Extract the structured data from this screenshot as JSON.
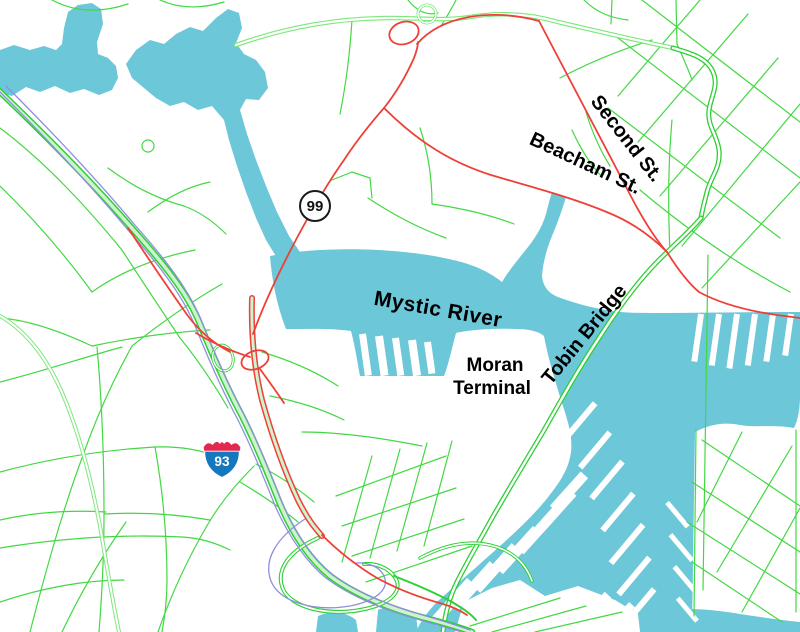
{
  "map": {
    "labels": {
      "second_st": "Second St.",
      "beacham_st": "Beacham St.",
      "mystic_river": "Mystic River",
      "moran_terminal_line1": "Moran",
      "moran_terminal_line2": "Terminal",
      "tobin_bridge": "Tobin Bridge"
    },
    "shields": {
      "interstate_93": "93",
      "route_99": "99"
    },
    "colors": {
      "water": "#6cc7d9",
      "land": "#ffffff",
      "road_minor": "#43d843",
      "highway_casing": "#2ecf35",
      "highway_fill": "#cdf4cd",
      "parkway_casing": "#7de87d",
      "road_red": "#ee4038",
      "rail": "#8f8fde",
      "shield_blue": "#1578bd",
      "shield_red": "#e22a50",
      "shield_ring": "#1a1a1a",
      "label_text": "#000000"
    }
  }
}
